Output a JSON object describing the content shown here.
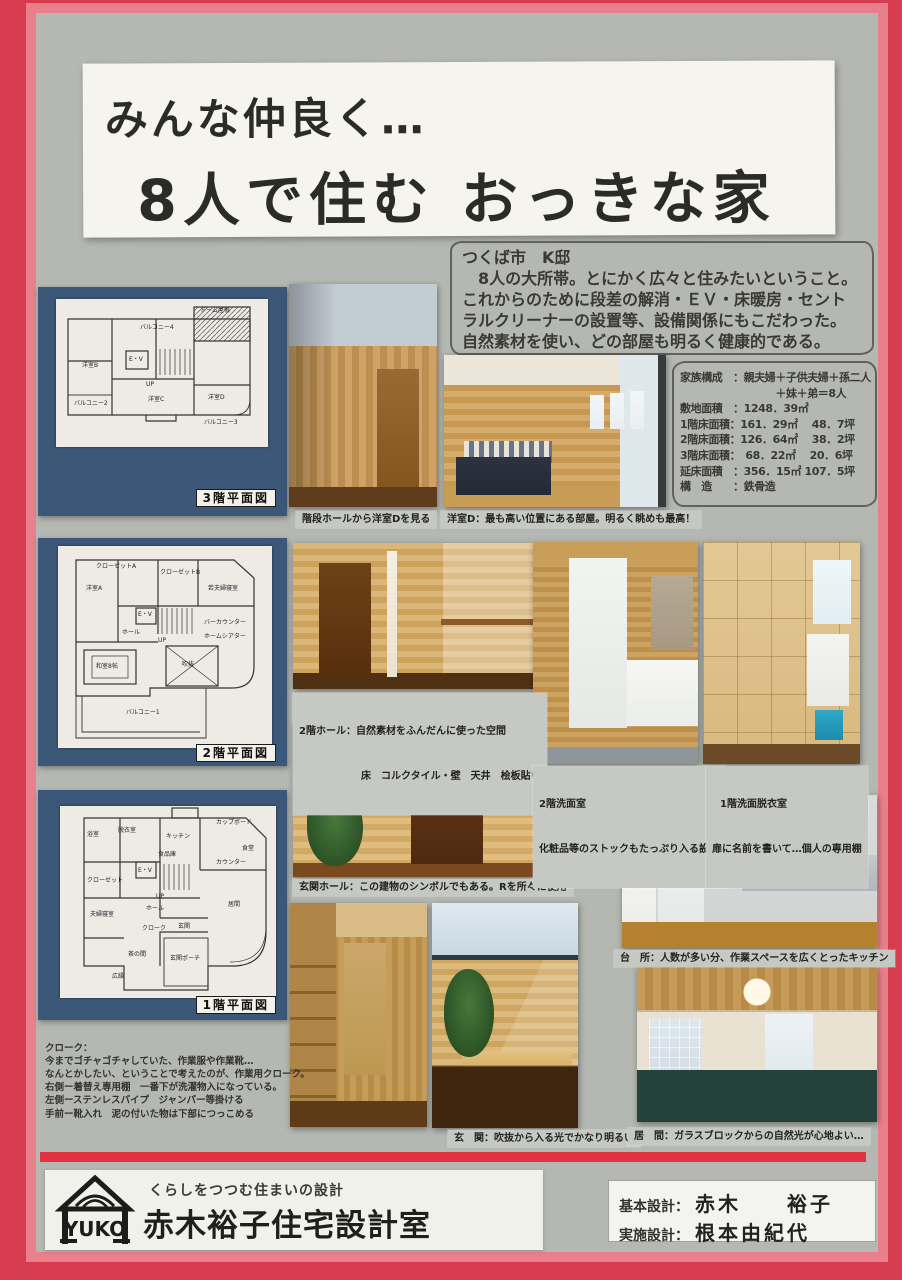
{
  "colors": {
    "frame_red": "#d63b4e",
    "frame_pink": "#e87f8b",
    "board_gray": "#b4b7b2",
    "panel_navy": "#3c5878",
    "banner_white": "#f6f4ee",
    "bar_red": "#e23140"
  },
  "title": {
    "line1": "みんな仲良く…",
    "line2": "8人で住む おっきな家"
  },
  "intro": {
    "location": "つくば市　K邸",
    "lines": [
      "　8人の大所帯。とにかく広々と住みたいということ。",
      "これからのために段差の解消・ＥＶ・床暖房・セント",
      "ラルクリーナーの設置等、設備関係にもこだわった。",
      "自然素材を使い、どの部屋も明るく健康的である。"
    ]
  },
  "specs": {
    "rows": [
      "家族構成　：親夫婦＋子供夫婦＋孫二人",
      "　　　　　　　　　＋妹＋弟＝8人",
      "敷地面積　：1248．39㎡",
      "1階床面積：161．29㎡　 48．7坪",
      "2階床面積：126．64㎡　 38．2坪",
      "3階床面積：　68．22㎡　 20．6坪",
      "延床面積　：356．15㎡ 107．5坪",
      "構　造　　：鉄骨造"
    ]
  },
  "plans": {
    "f3": {
      "label": "3階平面図",
      "labels": [
        "ドーム屋根",
        "バルコニー4",
        "洋室B",
        "E・V",
        "UP",
        "洋室C",
        "洋室D",
        "バルコニー2",
        "バルコニー3"
      ]
    },
    "f2": {
      "label": "2階平面図",
      "labels": [
        "クローゼットA",
        "洋室A",
        "クローゼットB",
        "若夫婦寝室",
        "E・V",
        "UP",
        "ホール",
        "バーカウンター",
        "ホームシアター",
        "和室8帖",
        "吹抜",
        "バルコニー1"
      ]
    },
    "f1": {
      "label": "1階平面図",
      "labels": [
        "浴室",
        "脱衣室",
        "キッチン",
        "カップボード",
        "食堂",
        "カウンター",
        "食品庫",
        "E・V",
        "UP",
        "ホール",
        "クローゼット",
        "夫婦寝室",
        "クローク",
        "玄関",
        "茶の間",
        "広縁",
        "玄関ポーチ",
        "居間"
      ]
    }
  },
  "captions": {
    "stairs": "階段ホールから洋室Dを見る",
    "bedroom": "洋室D：最も高い位置にある部屋。明るく眺めも最高！",
    "hall2f_1": "2階ホール：自然素材をふんだんに使った空間",
    "hall2f_2": "床　コルクタイル・壁　天井　桧板貼り",
    "entrance_hall": "玄関ホール：この建物のシンボルでもある。Rを所々に使用",
    "wash2f_1": "2階洗面室",
    "wash2f_2": "化粧品等のストックもたっぷり入る設計",
    "wash1f_1": "1階洗面脱衣室",
    "wash1f_2": "扉に名前を書いて…個人の専用棚",
    "kitchen": "台　所：人数が多い分、作業スペースを広くとったキッチン",
    "entrance": "玄　関：吹抜から入る光でかなり明るい",
    "living": "居　間：ガラスブロックからの自然光が心地よい…"
  },
  "cloak_note": {
    "lines": [
      "クローク：",
      "今までゴチャゴチャしていた、作業服や作業靴…",
      "なんとかしたい、ということで考えたのが、作業用クローク。",
      "右側ー着替え専用棚　一番下が洗濯物入になっている。",
      "左側ーステンレスパイプ　ジャンパー等掛ける",
      "手前ー靴入れ　泥の付いた物は下部につっこめる"
    ]
  },
  "footer": {
    "logo_text": "YUKO",
    "tagline": "くらしをつつむ住まいの設計",
    "company": "赤木裕子住宅設計室",
    "credits": [
      {
        "label": "基本設計：",
        "name": "赤木　　裕子"
      },
      {
        "label": "実施設計：",
        "name": "根本由紀代"
      }
    ]
  }
}
